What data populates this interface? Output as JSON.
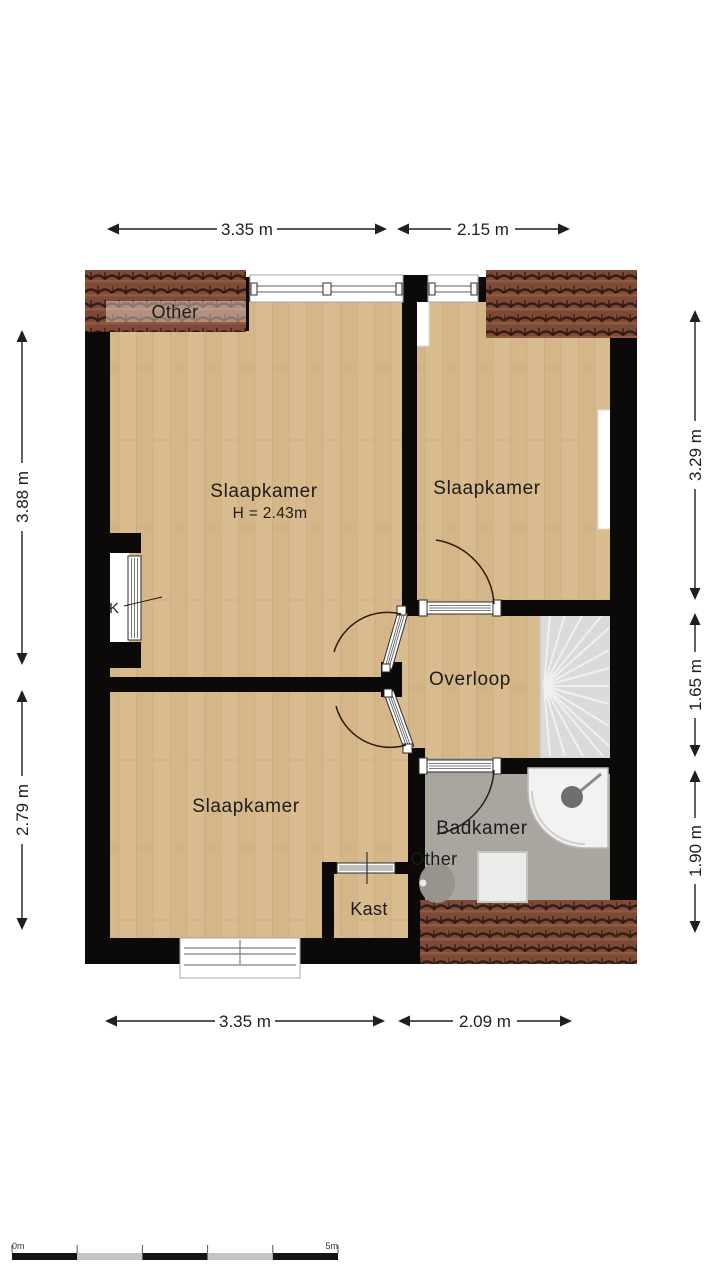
{
  "plan": {
    "rooms": {
      "other_top": "Other",
      "slaapkamer_main": "Slaapkamer",
      "slaapkamer_main_height": "H = 2.43m",
      "slaapkamer_right": "Slaapkamer",
      "k_closet": "K",
      "overloop": "Overloop",
      "slaapkamer_bottom": "Slaapkamer",
      "kast": "Kast",
      "badkamer": "Badkamer",
      "other_badkamer": "Other"
    },
    "dimensions": {
      "top": [
        {
          "label": "3.35 m"
        },
        {
          "label": "2.15 m"
        }
      ],
      "bottom": [
        {
          "label": "3.35 m"
        },
        {
          "label": "2.09 m"
        }
      ],
      "left": [
        {
          "label": "3.88 m"
        },
        {
          "label": "2.79 m"
        }
      ],
      "right": [
        {
          "label": "3.29 m"
        },
        {
          "label": "1.65 m"
        },
        {
          "label": "1.90 m"
        }
      ]
    },
    "scale_bar": {
      "start": "0m",
      "end": "5m"
    },
    "colors": {
      "wall": "#0b0a09",
      "wood": "#d8bb8f",
      "bath_floor": "#a9a6a0",
      "stairs": "#dadada",
      "roof": "#7d4a38",
      "dim": "#1f1f1f"
    }
  }
}
